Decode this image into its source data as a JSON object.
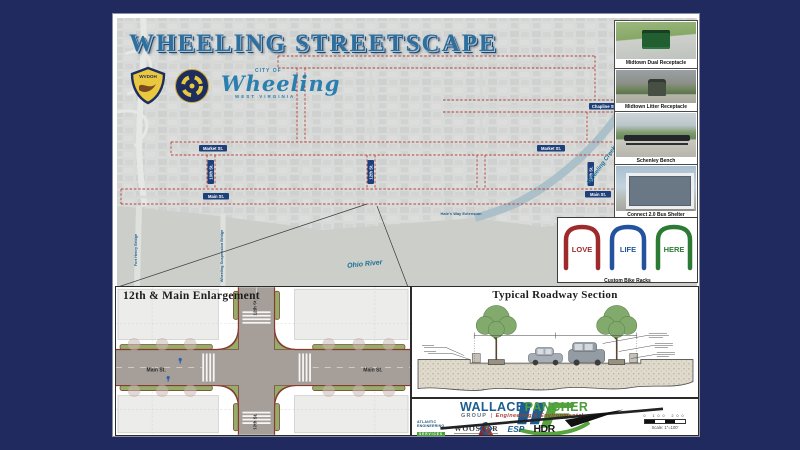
{
  "frame": {
    "background_color": "#212a5e"
  },
  "poster": {
    "title": "WHEELING STREETSCAPE",
    "header_logos": {
      "wvdoh_label": "WVDOH",
      "city_of": "CITY OF",
      "city_name": "Wheeling",
      "state": "WEST VIRGINIA"
    },
    "map": {
      "corridor_color": "#b23b33",
      "labels": {
        "chapline": "Chapline St.",
        "market_left": "Market St.",
        "market_right": "Market St.",
        "main_left": "Main St.",
        "main_right": "Main St.",
        "tenth": "10th St.",
        "twelfth": "12th St.",
        "sixteenth": "16th St.",
        "creek": "Wheeling Creek",
        "river": "Ohio River",
        "fort_henry": "Fort Henry Bridge",
        "suspension": "Wheeling Suspension Bridge",
        "extension": "Hale's Way Extension"
      }
    },
    "sidebar": {
      "cards": [
        {
          "caption": "Midtown Dual Receptacle"
        },
        {
          "caption": "Midtown Litter Receptacle"
        },
        {
          "caption": "Schenley Bench"
        },
        {
          "caption": "Connect 2.0 Bus Shelter"
        }
      ],
      "bike_racks": {
        "words": [
          "LOVE",
          "LIFE",
          "HERE"
        ],
        "colors": [
          "#9e2b2b",
          "#23539e",
          "#2c7a34"
        ],
        "caption": "Custom Bike Racks"
      }
    },
    "enlargement": {
      "title": "12th & Main Enlargement",
      "main_left": "Main St.",
      "main_right": "Main St.",
      "cross_top": "12th St.",
      "cross_bottom": "12th St."
    },
    "section": {
      "title": "Typical Roadway Section"
    },
    "footer": {
      "brand_first": "WALLACE",
      "brand_second": "PANCHER",
      "group": "GROUP",
      "divider": "|",
      "tagline": "Engineering & Environmental",
      "partners": {
        "atlantic_line1": "ATLANTIC",
        "atlantic_line2": "ENGINEERING",
        "atlantic_line3": "SERVICES",
        "wooster": "WOOSTER",
        "esp": "ESP",
        "hdr": "HDR"
      },
      "scale_ticks": "0  100  200",
      "scale_label": "Scale: 1\"=100'"
    }
  }
}
